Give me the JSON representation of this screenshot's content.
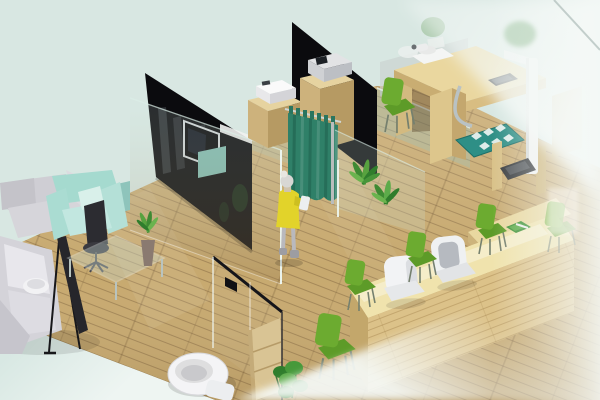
{
  "meta": {
    "kind": "3d-isometric-interior-render",
    "width": 600,
    "height": 400,
    "description": "Isometric 3D rendering of a clinic/office interior: waiting lounge with sofas, black partition wall with TV, consultation cubicle with teal privacy curtain, exam desks with devices, height/weight station, long wooden reception counter with green chairs, restroom with toilet behind glass, frosted glass wall on the right"
  },
  "palette": {
    "background": "#d8e7e2",
    "background_fade": "#eef5f2",
    "floor_wood": "#c7a96f",
    "floor_seam": "#6d5030",
    "wall_black": "#0b0b0e",
    "tv_frame": "#cdd2d4",
    "curtain_teal": "#2f8068",
    "glass_edge": "#eef8f3",
    "glass_warm_tint": "#96halo",
    "sofa_gray": "#d6d5da",
    "armchair_mint": "#a5dacf",
    "office_chair_dark": "#2c2c31",
    "counter_wood": "#dcc289",
    "counter_top": "#f0e3ad",
    "cabinet_wood": "#cdb27c",
    "chair_green": "#6cab30",
    "chair_green_dark": "#5d9b28",
    "plant_green": "#3e8a33",
    "person_dress_yellow": "#e2d32a",
    "person_skin_gray": "#d8d7d4",
    "mat_teal": "#2e8f86",
    "haze_white": "#f4f8f6",
    "scale_dark": "#3a3d40",
    "toilet_white": "#f4f4f6"
  },
  "scene": {
    "areas": [
      {
        "name": "waiting-lounge",
        "position": "left",
        "items": "gray L-sofa, mint armchair, dark office chair, glass coffee table, plant vase, banner stand"
      },
      {
        "name": "consultation-cubicles",
        "position": "center-top",
        "items": "black partition walls, wall TV, wooden cabinets with printer and copier, teal privacy curtain, standing person"
      },
      {
        "name": "exam-station",
        "position": "top-right",
        "items": "wooden exam desk, white device, embedded screen, height-measure column, weighing scale, teal foot mat"
      },
      {
        "name": "reception",
        "position": "bottom-right",
        "items": "long wooden counter, two white chairs, green visitor chairs, green tray"
      },
      {
        "name": "restroom",
        "position": "bottom-center",
        "items": "glass partition, toilet, wooden shelf, plant"
      }
    ],
    "objects": [
      {
        "name": "mint-background",
        "color": "#d8e7e2"
      },
      {
        "name": "wood-plank-floor",
        "color": "#c7a96f"
      },
      {
        "name": "black-partition-wall-left",
        "color": "#0b0b0e"
      },
      {
        "name": "wall-mounted-tv",
        "color": "#07070a"
      },
      {
        "name": "black-partition-wall-center",
        "color": "#0b0b0e"
      },
      {
        "name": "glass-partition-panels",
        "color": "rgba(210,232,224,0.2)"
      },
      {
        "name": "privacy-curtain",
        "color": "#2f8068"
      },
      {
        "name": "standing-person",
        "colors": [
          "#e2d32a",
          "#d8d7d4",
          "#b9b9bd"
        ]
      },
      {
        "name": "printer-cabinet",
        "color": "#cdb27c"
      },
      {
        "name": "copier-cabinet",
        "color": "#cdb27c"
      },
      {
        "name": "floor-plants",
        "color": "#3e8a33"
      },
      {
        "name": "exam-desk",
        "color": "#ead79f"
      },
      {
        "name": "white-exam-device",
        "color": "#f4f5f4"
      },
      {
        "name": "height-measure-column",
        "color": "#f2f3f2"
      },
      {
        "name": "weighing-scale",
        "color": "#3a3d40"
      },
      {
        "name": "teal-foot-mat",
        "color": "#2e8f86"
      },
      {
        "name": "reception-counter",
        "color": "#dcc289"
      },
      {
        "name": "white-office-chairs",
        "color": "#f2f3f5"
      },
      {
        "name": "green-visitor-chairs",
        "color": "#6cab30"
      },
      {
        "name": "gray-sofa",
        "color": "#d6d5da"
      },
      {
        "name": "mint-armchair",
        "color": "#a5dacf"
      },
      {
        "name": "dark-office-chair",
        "color": "#2c2c31"
      },
      {
        "name": "glass-coffee-table",
        "color": "rgba(200,220,212,0.35)"
      },
      {
        "name": "banner-stand",
        "color": "#17171a"
      },
      {
        "name": "toilet",
        "color": "#f4f4f6"
      },
      {
        "name": "restroom-glass-wall",
        "color": "rgba(205,190,150,0.18)"
      },
      {
        "name": "wooden-shelf",
        "color": "#dcc694"
      },
      {
        "name": "frosted-glass-wall-right",
        "color": "#f4f8f6"
      }
    ]
  }
}
